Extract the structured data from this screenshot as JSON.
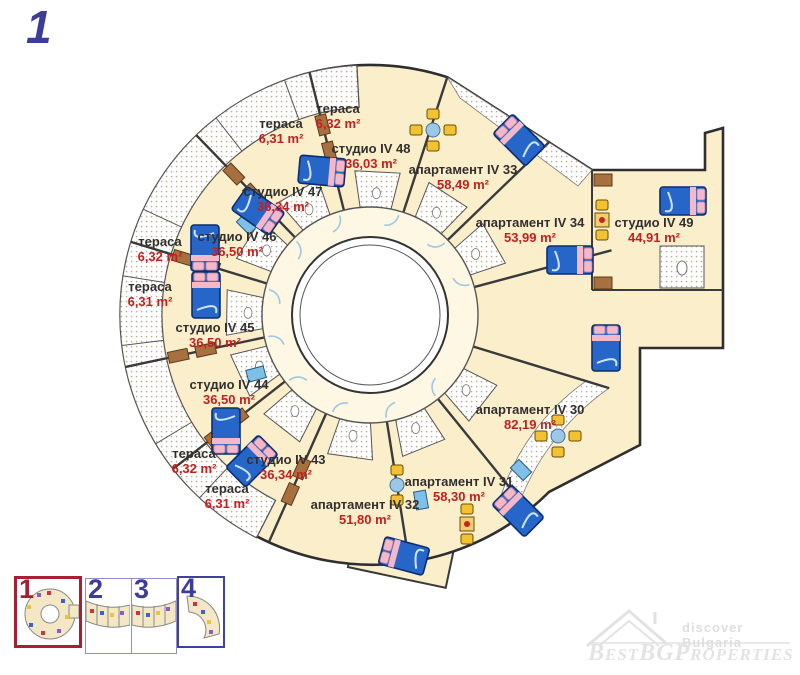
{
  "page": {
    "floor_number": "1"
  },
  "colors": {
    "cream": "#FAEECB",
    "corridor_fill": "#FDF7E4",
    "wall": "#3a3a3a",
    "door_blue": "#9CC8E0",
    "bed_blue": "#2666C8",
    "bed_border": "#0C2D70",
    "pink": "#F3B9CB",
    "wood_brown": "#A8703F",
    "chair_yellow": "#F2C233",
    "area_red": "#C41F1F",
    "label_dark": "#332F2F",
    "navy": "#3D3D99",
    "crimson": "#A81F33",
    "watermark_gray": "#E2E2E2"
  },
  "units": [
    {
      "name": "тераса",
      "area": "6,32 m²",
      "x": 338,
      "y": 101
    },
    {
      "name": "тераса",
      "area": "6,31 m²",
      "x": 281,
      "y": 116
    },
    {
      "name": "студио IV 48",
      "area": "36,03 m²",
      "x": 371,
      "y": 141,
      "angle": 87
    },
    {
      "name": "студио IV 47",
      "area": "36,34 m²",
      "x": 283,
      "y": 184,
      "angle": 120
    },
    {
      "name": "студио IV 46",
      "area": "36,50 m²",
      "x": 237,
      "y": 229,
      "angle": 148
    },
    {
      "name": "тераса",
      "area": "6,32 m²",
      "x": 160,
      "y": 234
    },
    {
      "name": "тераса",
      "area": "6,31 m²",
      "x": 150,
      "y": 279
    },
    {
      "name": "студио IV 45",
      "area": "36,50 m²",
      "x": 215,
      "y": 320,
      "angle": 179
    },
    {
      "name": "студио IV 44",
      "area": "36,50 m²",
      "x": 229,
      "y": 377,
      "angle": 205
    },
    {
      "name": "тераса",
      "area": "6,32 m²",
      "x": 194,
      "y": 446
    },
    {
      "name": "тераса",
      "area": "6,31 m²",
      "x": 227,
      "y": 481
    },
    {
      "name": "студио IV 43",
      "area": "36,34 m²",
      "x": 286,
      "y": 452,
      "angle": 232
    },
    {
      "name": "апартамент IV 32",
      "area": "51,80 m²",
      "x": 365,
      "y": 497,
      "angle": 262
    },
    {
      "name": "апартамент IV 31",
      "area": "58,30 m²",
      "x": 459,
      "y": 474,
      "angle": 292
    },
    {
      "name": "апартамент IV 30",
      "area": "82,19 m²",
      "x": 530,
      "y": 402,
      "angle": 322
    },
    {
      "name": "апартамент IV 33",
      "area": "58,49 m²",
      "x": 463,
      "y": 162,
      "angle": 57
    },
    {
      "name": "апартамент IV 34",
      "area": "53,99 m²",
      "x": 530,
      "y": 215,
      "angle": 30
    },
    {
      "name": "студио IV 49",
      "area": "44,91 m²",
      "x": 654,
      "y": 215
    }
  ],
  "furniture": {
    "beds": [
      {
        "x": 322,
        "y": 171,
        "rot": 5
      },
      {
        "x": 258,
        "y": 211,
        "rot": 35
      },
      {
        "x": 205,
        "y": 248,
        "rot": 90
      },
      {
        "x": 206,
        "y": 295,
        "rot": -90
      },
      {
        "x": 226,
        "y": 431,
        "rot": 90
      },
      {
        "x": 252,
        "y": 461,
        "rot": -45
      },
      {
        "x": 404,
        "y": 556,
        "rot": 195
      },
      {
        "x": 518,
        "y": 511,
        "rot": -135
      },
      {
        "x": 606,
        "y": 348,
        "rot": -90
      },
      {
        "x": 519,
        "y": 140,
        "rot": -135
      },
      {
        "x": 570,
        "y": 260,
        "rot": 0
      },
      {
        "x": 683,
        "y": 201,
        "rot": 0
      }
    ],
    "tables": [
      {
        "x": 558,
        "y": 436,
        "chairs": 4,
        "center": "blue"
      },
      {
        "x": 433,
        "y": 130,
        "chairs": 4,
        "center": "blue"
      },
      {
        "x": 467,
        "y": 524,
        "chairs": 2,
        "center": "reddot"
      },
      {
        "x": 602,
        "y": 220,
        "chairs": 2,
        "center": "reddot"
      },
      {
        "x": 397,
        "y": 485,
        "chairs": 2,
        "center": "blue"
      }
    ],
    "kitchens": [
      {
        "x": 247,
        "y": 224,
        "rot": 45
      },
      {
        "x": 256,
        "y": 374,
        "rot": -15
      },
      {
        "x": 421,
        "y": 500,
        "rot": 80
      },
      {
        "x": 521,
        "y": 470,
        "rot": 45
      }
    ],
    "wardrobes": [
      {
        "x": 603,
        "y": 180,
        "rot": 0
      },
      {
        "x": 603,
        "y": 283,
        "rot": 0
      }
    ]
  },
  "thumbnails": [
    {
      "label": "1",
      "active": true
    },
    {
      "label": "2",
      "active": false
    },
    {
      "label": "3",
      "active": false
    },
    {
      "label": "4",
      "active": false
    }
  ],
  "watermark": {
    "tagline": "discover Bulgaria",
    "brand": "BestBGProperties"
  }
}
